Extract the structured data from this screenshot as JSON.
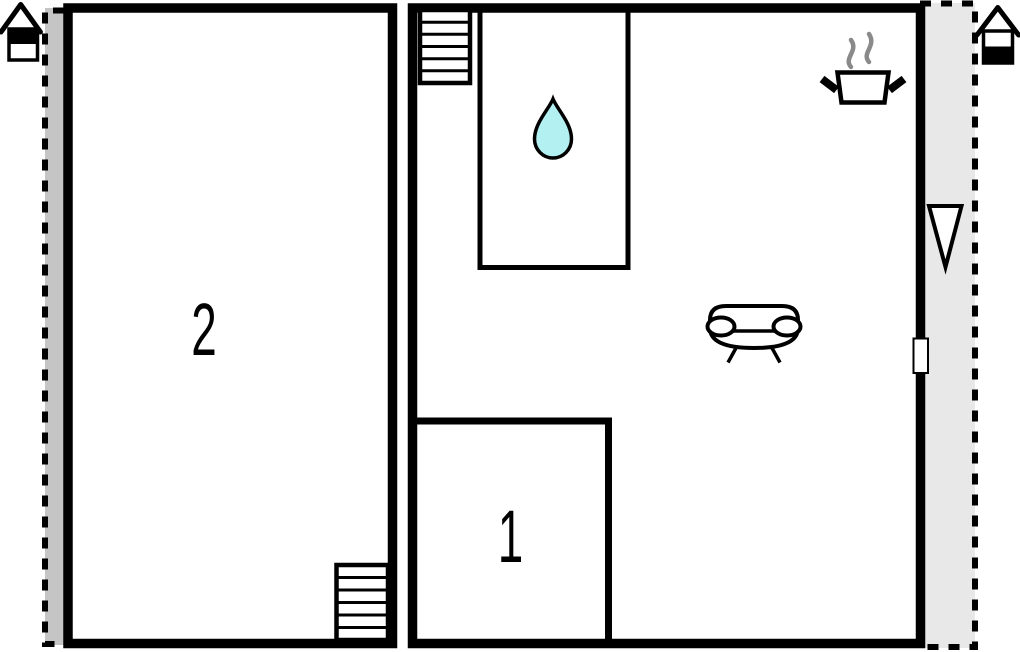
{
  "floorplan": {
    "room_labels": {
      "left_room": "2",
      "bottom_room": "1"
    },
    "colors": {
      "wall": "#000000",
      "floor": "#ffffff",
      "terrace_left": "#c5c5c5",
      "terrace_right": "#e8e8e8",
      "water_drop": "#b3f0f2",
      "steam": "#8a8a8a"
    },
    "icons": [
      "house-level-upper-icon",
      "house-level-lower-icon",
      "stairs-upper-icon",
      "stairs-lower-icon",
      "water-drop-icon",
      "stove-pot-icon",
      "sofa-icon",
      "entrance-arrow-icon",
      "door-marker-icon"
    ]
  }
}
